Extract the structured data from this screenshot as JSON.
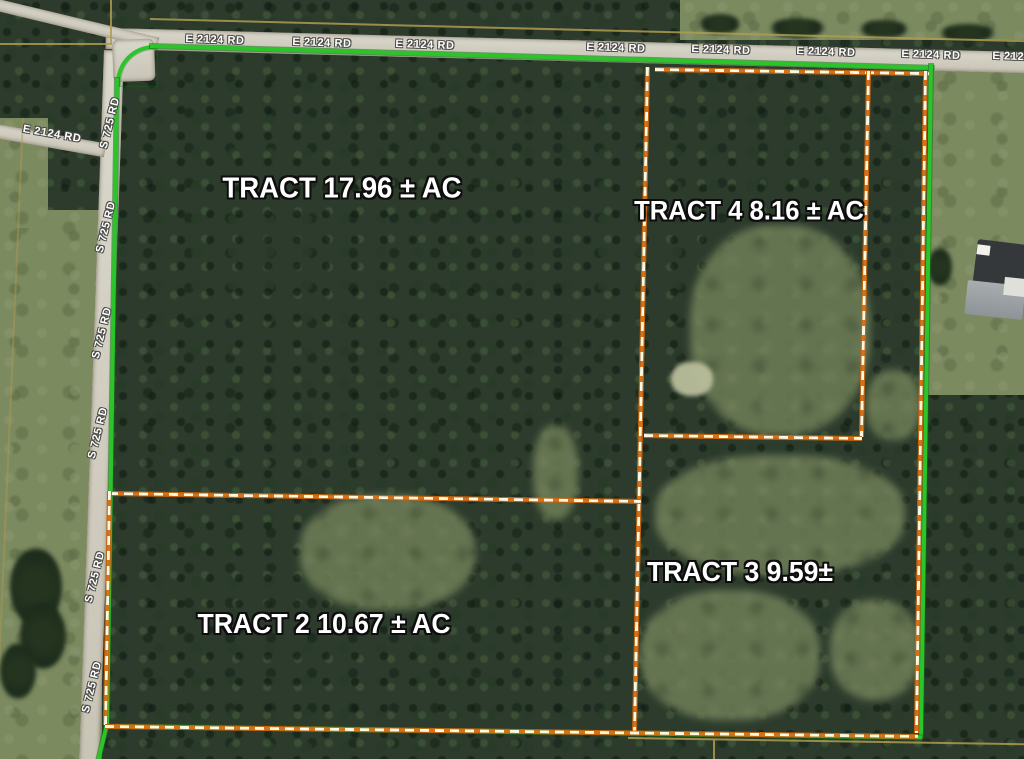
{
  "tracts": [
    {
      "id": "tract-1",
      "label": "TRACT 17.96 ± AC"
    },
    {
      "id": "tract-4",
      "label": "TRACT 4 8.16 ± AC"
    },
    {
      "id": "tract-3",
      "label": "TRACT 3 9.59±"
    },
    {
      "id": "tract-2",
      "label": "TRACT 2 10.67 ± AC"
    }
  ],
  "roads": {
    "top_label": "E 2124 RD",
    "left_label": "S 725 RD",
    "left_branch_label": "E 2124 RD"
  },
  "colors": {
    "boundary_green": "#2bc42b",
    "boundary_orange": "#dd7014",
    "boundary_dash_fill": "#fdf6e0",
    "road_surface": "#d2cfc4",
    "forest": "#2c3b2c",
    "field": "#7c8a60"
  }
}
